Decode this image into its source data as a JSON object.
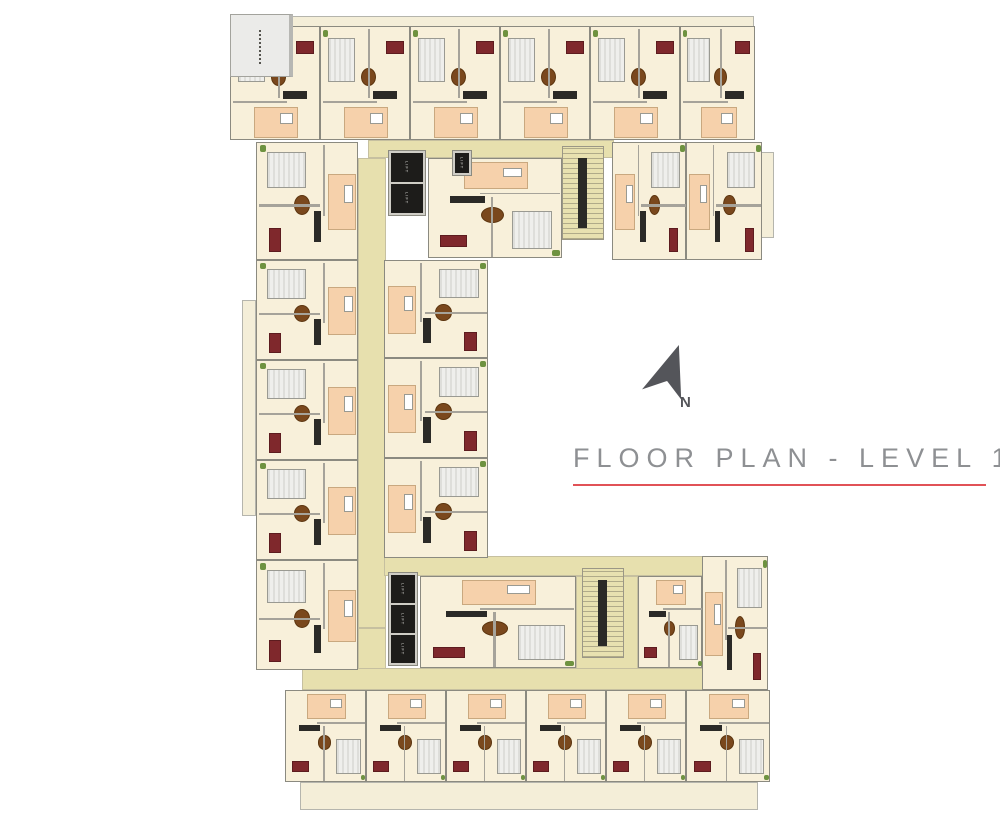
{
  "page": {
    "width": 1000,
    "height": 828,
    "background": "#ffffff"
  },
  "title": {
    "text": "FLOOR PLAN - LEVEL 1",
    "color": "#8e9093",
    "underline_color": "#e15257"
  },
  "compass": {
    "label": "N",
    "color": "#54555a"
  },
  "palette": {
    "apartment_floor": "#f8f0da",
    "corridor": "#e7e0ae",
    "terrace": "#f4eed8",
    "bathroom": "#f6d1ab",
    "bed": "#ededea",
    "sofa_accent": "#7f282c",
    "dining_table": "#7a481d",
    "lift_shaft": "#1d1c1a",
    "wall": "#8b8a80",
    "roof_area": "#ebebe9",
    "plant": "#6e9240"
  },
  "plan": {
    "lift_label": "LIFT",
    "roof": {
      "x": 230,
      "y": 14,
      "w": 63,
      "h": 63
    },
    "terraces": [
      {
        "x": 248,
        "y": 16,
        "w": 506,
        "h": 12
      },
      {
        "x": 242,
        "y": 300,
        "w": 14,
        "h": 216
      },
      {
        "x": 760,
        "y": 152,
        "w": 14,
        "h": 86
      },
      {
        "x": 300,
        "y": 782,
        "w": 458,
        "h": 28
      }
    ],
    "corridors": [
      {
        "x": 368,
        "y": 140,
        "w": 246,
        "h": 18
      },
      {
        "x": 358,
        "y": 158,
        "w": 28,
        "h": 470
      },
      {
        "x": 358,
        "y": 628,
        "w": 28,
        "h": 42
      },
      {
        "x": 384,
        "y": 556,
        "w": 322,
        "h": 20
      },
      {
        "x": 576,
        "y": 576,
        "w": 62,
        "h": 112
      },
      {
        "x": 302,
        "y": 668,
        "w": 408,
        "h": 22
      }
    ],
    "stairs": [
      {
        "x": 562,
        "y": 146,
        "w": 42,
        "h": 94
      },
      {
        "x": 582,
        "y": 568,
        "w": 42,
        "h": 90
      }
    ],
    "units": [
      {
        "x": 230,
        "y": 26,
        "w": 90,
        "h": 114,
        "orient": "up"
      },
      {
        "x": 320,
        "y": 26,
        "w": 90,
        "h": 114,
        "orient": "up"
      },
      {
        "x": 410,
        "y": 26,
        "w": 90,
        "h": 114,
        "orient": "up"
      },
      {
        "x": 500,
        "y": 26,
        "w": 90,
        "h": 114,
        "orient": "up"
      },
      {
        "x": 590,
        "y": 26,
        "w": 90,
        "h": 114,
        "orient": "up"
      },
      {
        "x": 680,
        "y": 26,
        "w": 75,
        "h": 114,
        "orient": "up"
      },
      {
        "x": 612,
        "y": 142,
        "w": 74,
        "h": 118,
        "orient": "right"
      },
      {
        "x": 686,
        "y": 142,
        "w": 76,
        "h": 118,
        "orient": "right"
      },
      {
        "x": 428,
        "y": 158,
        "w": 134,
        "h": 100,
        "orient": "down"
      },
      {
        "x": 256,
        "y": 142,
        "w": 102,
        "h": 118,
        "orient": "left"
      },
      {
        "x": 256,
        "y": 260,
        "w": 102,
        "h": 100,
        "orient": "left"
      },
      {
        "x": 256,
        "y": 360,
        "w": 102,
        "h": 100,
        "orient": "left"
      },
      {
        "x": 256,
        "y": 460,
        "w": 102,
        "h": 100,
        "orient": "left"
      },
      {
        "x": 256,
        "y": 560,
        "w": 102,
        "h": 110,
        "orient": "left"
      },
      {
        "x": 384,
        "y": 260,
        "w": 104,
        "h": 98,
        "orient": "right"
      },
      {
        "x": 384,
        "y": 358,
        "w": 104,
        "h": 100,
        "orient": "right"
      },
      {
        "x": 384,
        "y": 458,
        "w": 104,
        "h": 100,
        "orient": "right"
      },
      {
        "x": 420,
        "y": 576,
        "w": 156,
        "h": 92,
        "orient": "down"
      },
      {
        "x": 638,
        "y": 576,
        "w": 64,
        "h": 92,
        "orient": "down"
      },
      {
        "x": 702,
        "y": 556,
        "w": 66,
        "h": 134,
        "orient": "right"
      },
      {
        "x": 285,
        "y": 690,
        "w": 81,
        "h": 92,
        "orient": "down"
      },
      {
        "x": 366,
        "y": 690,
        "w": 80,
        "h": 92,
        "orient": "down"
      },
      {
        "x": 446,
        "y": 690,
        "w": 80,
        "h": 92,
        "orient": "down"
      },
      {
        "x": 526,
        "y": 690,
        "w": 80,
        "h": 92,
        "orient": "down"
      },
      {
        "x": 606,
        "y": 690,
        "w": 80,
        "h": 92,
        "orient": "down"
      },
      {
        "x": 686,
        "y": 690,
        "w": 84,
        "h": 92,
        "orient": "down"
      }
    ],
    "lifts": [
      {
        "x": 388,
        "y": 150,
        "w": 38,
        "h": 66,
        "shafts": 2
      },
      {
        "x": 452,
        "y": 150,
        "w": 20,
        "h": 26,
        "shafts": 1
      },
      {
        "x": 388,
        "y": 572,
        "w": 30,
        "h": 94,
        "shafts": 3
      }
    ],
    "unit_furniture": [
      {
        "name": "plant-icon",
        "cls": "plant",
        "u": 0.02,
        "v": 0.03,
        "du": 0.06,
        "dv": 0.06
      },
      {
        "name": "bed-icon",
        "cls": "bed",
        "u": 0.08,
        "v": 0.1,
        "du": 0.3,
        "dv": 0.38
      },
      {
        "name": "sofa-icon",
        "cls": "sofa",
        "u": 0.72,
        "v": 0.12,
        "du": 0.2,
        "dv": 0.12
      },
      {
        "name": "dining-table-icon",
        "cls": "table",
        "u": 0.44,
        "v": 0.36,
        "du": 0.17,
        "dv": 0.16
      },
      {
        "name": "tv-unit-icon",
        "cls": "tv",
        "u": 0.58,
        "v": 0.56,
        "du": 0.26,
        "dv": 0.07
      },
      {
        "name": "bathroom-zone",
        "cls": "bath",
        "u": 0.26,
        "v": 0.7,
        "du": 0.48,
        "dv": 0.27
      },
      {
        "name": "wall-line",
        "cls": "wall-line",
        "u": 0.52,
        "v": 0.02,
        "du": 0.02,
        "dv": 0.6
      },
      {
        "name": "wall-line",
        "cls": "wall-line",
        "u": 0.02,
        "v": 0.645,
        "du": 0.6,
        "dv": 0.018
      }
    ]
  }
}
